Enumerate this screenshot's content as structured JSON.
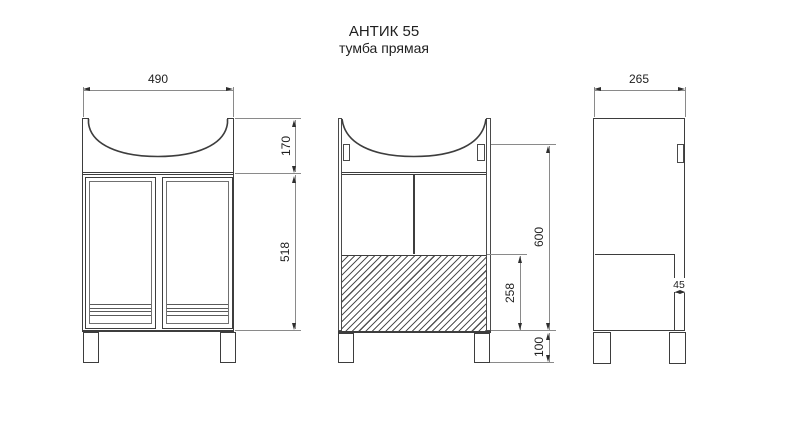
{
  "title": {
    "line1": "АНТИК 55",
    "line2": "тумба прямая"
  },
  "dims": {
    "front_width": "490",
    "basin_height": "170",
    "cabinet_body_height": "518",
    "internal_height": "600",
    "bottom_zone_height": "258",
    "leg_height": "100",
    "side_depth": "265",
    "front_offset": "45"
  },
  "colors": {
    "object_line": "#3d3d3d",
    "dimension_line": "#8a8a8a",
    "text": "#1f1f1f",
    "background": "#ffffff"
  }
}
